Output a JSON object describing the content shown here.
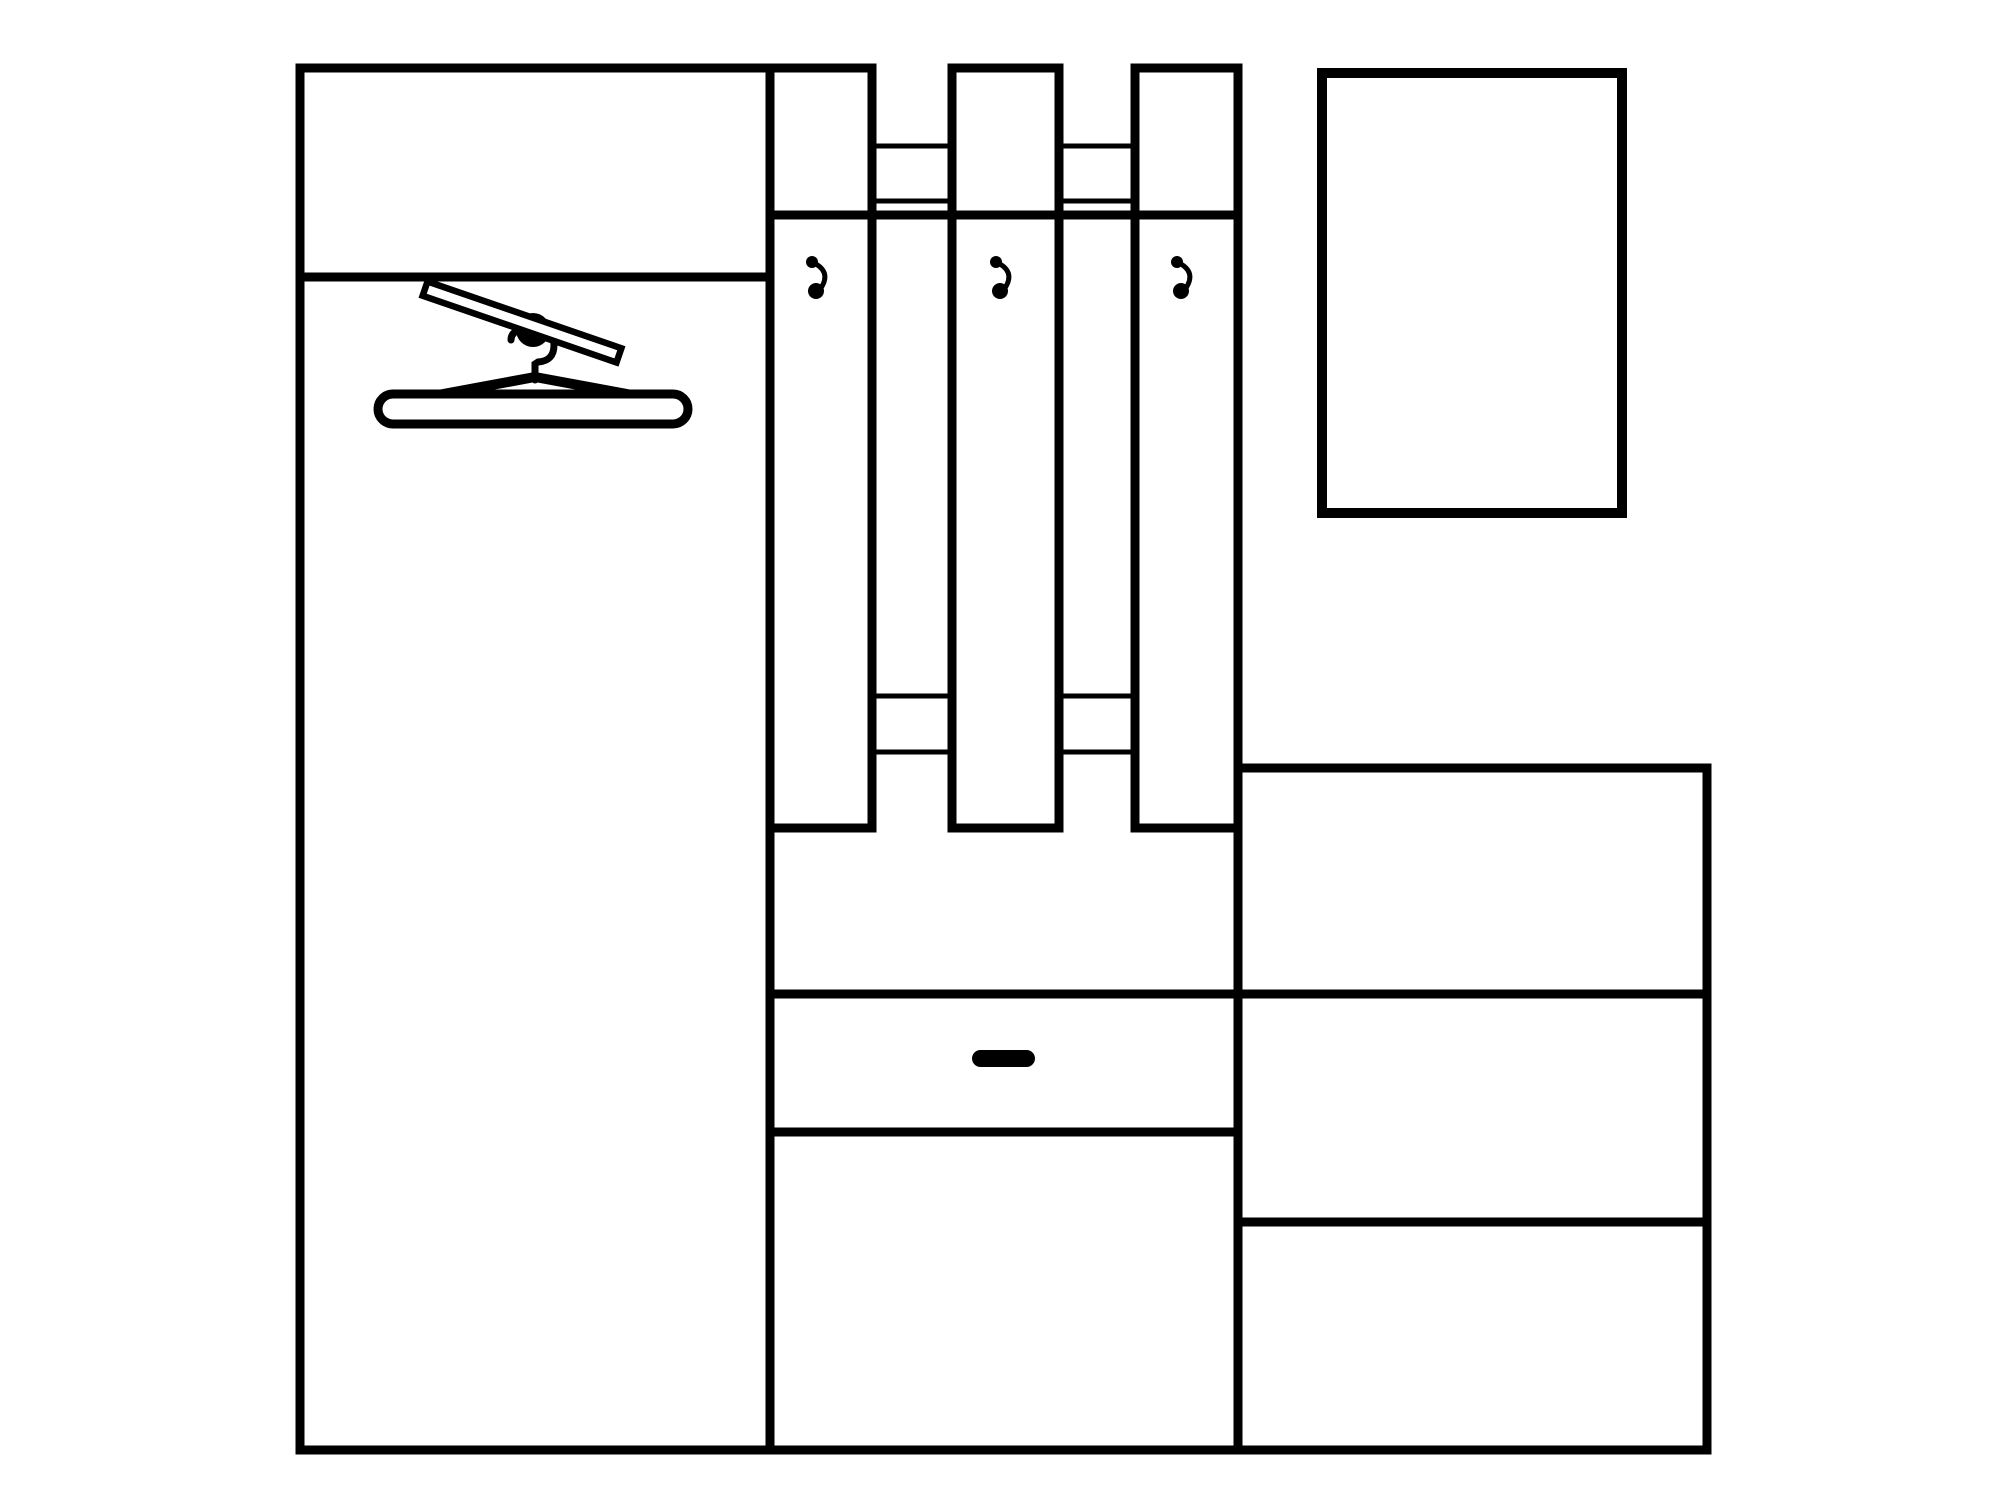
{
  "canvas": {
    "w": 2000,
    "h": 1500,
    "background": "#ffffff",
    "ink": "#000000"
  },
  "drawing": {
    "title": "hallway-furniture-line-drawing",
    "parts": [
      {
        "t": "rect",
        "name": "wardrobe-body",
        "x": 300,
        "y": 68,
        "w": 470,
        "h": 1382,
        "sw": 9
      },
      {
        "t": "line",
        "name": "wardrobe-shelf-line",
        "x1": 296,
        "y1": 277,
        "x2": 774,
        "y2": 277,
        "sw": 9
      },
      {
        "t": "rect",
        "name": "mirror",
        "x": 1322,
        "y": 73,
        "w": 300,
        "h": 440,
        "sw": 10
      },
      {
        "t": "rect",
        "name": "dresser-body",
        "x": 1238,
        "y": 768,
        "w": 469,
        "h": 682,
        "sw": 9
      },
      {
        "t": "line",
        "name": "dresser-divider-top",
        "x1": 1238,
        "y1": 994,
        "x2": 1707,
        "y2": 994,
        "sw": 9
      },
      {
        "t": "line",
        "name": "dresser-divider-bottom",
        "x1": 1238,
        "y1": 1222,
        "x2": 1707,
        "y2": 1222,
        "sw": 9
      },
      {
        "t": "line",
        "name": "cabinet-drawer-top-line",
        "x1": 770,
        "y1": 994,
        "x2": 1238,
        "y2": 994,
        "sw": 9
      },
      {
        "t": "line",
        "name": "cabinet-drawer-bottom-line",
        "x1": 770,
        "y1": 1132,
        "x2": 1238,
        "y2": 1132,
        "sw": 9
      },
      {
        "t": "line",
        "name": "cabinet-bottom-line",
        "x1": 766,
        "y1": 1450,
        "x2": 1242,
        "y2": 1450,
        "sw": 9
      },
      {
        "t": "rect",
        "name": "coat-panel-left",
        "x": 770,
        "y": 68,
        "w": 102,
        "h": 760,
        "sw": 9
      },
      {
        "t": "rect",
        "name": "coat-panel-middle",
        "x": 952,
        "y": 68,
        "w": 107,
        "h": 760,
        "sw": 9
      },
      {
        "t": "rect",
        "name": "coat-panel-right",
        "x": 1135,
        "y": 68,
        "w": 103,
        "h": 760,
        "sw": 9
      },
      {
        "t": "line",
        "name": "hat-shelf-line",
        "x1": 770,
        "y1": 215,
        "x2": 1238,
        "y2": 215,
        "sw": 9
      },
      {
        "t": "line",
        "name": "rail-upper-line1-gap1",
        "x1": 870,
        "y1": 146,
        "x2": 954,
        "y2": 146,
        "sw": 5
      },
      {
        "t": "line",
        "name": "rail-upper-line2-gap1",
        "x1": 870,
        "y1": 201,
        "x2": 954,
        "y2": 201,
        "sw": 5
      },
      {
        "t": "line",
        "name": "rail-upper-line1-gap2",
        "x1": 1057,
        "y1": 146,
        "x2": 1137,
        "y2": 146,
        "sw": 5
      },
      {
        "t": "line",
        "name": "rail-upper-line2-gap2",
        "x1": 1057,
        "y1": 201,
        "x2": 1137,
        "y2": 201,
        "sw": 5
      },
      {
        "t": "line",
        "name": "rail-lower-line1-gap1",
        "x1": 870,
        "y1": 696,
        "x2": 954,
        "y2": 696,
        "sw": 5
      },
      {
        "t": "line",
        "name": "rail-lower-line2-gap1",
        "x1": 870,
        "y1": 752,
        "x2": 954,
        "y2": 752,
        "sw": 5
      },
      {
        "t": "line",
        "name": "rail-lower-line1-gap2",
        "x1": 1057,
        "y1": 696,
        "x2": 1137,
        "y2": 696,
        "sw": 5
      },
      {
        "t": "line",
        "name": "rail-lower-line2-gap2",
        "x1": 1057,
        "y1": 752,
        "x2": 1137,
        "y2": 752,
        "sw": 5
      },
      {
        "t": "circle",
        "name": "coat-hook-1-top-dot-icon",
        "cx": 812,
        "cy": 262,
        "r": 6,
        "fill": true
      },
      {
        "t": "path",
        "name": "coat-hook-1-curve-icon",
        "d": "M 812 262 Q 832 271 821 288",
        "sw": 5
      },
      {
        "t": "circle",
        "name": "coat-hook-1-bottom-dot-icon",
        "cx": 816,
        "cy": 291,
        "r": 8,
        "fill": true
      },
      {
        "t": "circle",
        "name": "coat-hook-2-top-dot-icon",
        "cx": 996,
        "cy": 262,
        "r": 6,
        "fill": true
      },
      {
        "t": "path",
        "name": "coat-hook-2-curve-icon",
        "d": "M 996 262 Q 1016 271 1005 288",
        "sw": 5
      },
      {
        "t": "circle",
        "name": "coat-hook-2-bottom-dot-icon",
        "cx": 1000,
        "cy": 291,
        "r": 8,
        "fill": true
      },
      {
        "t": "circle",
        "name": "coat-hook-3-top-dot-icon",
        "cx": 1177,
        "cy": 262,
        "r": 6,
        "fill": true
      },
      {
        "t": "path",
        "name": "coat-hook-3-curve-icon",
        "d": "M 1177 262 Q 1197 271 1186 288",
        "sw": 5
      },
      {
        "t": "circle",
        "name": "coat-hook-3-bottom-dot-icon",
        "cx": 1181,
        "cy": 291,
        "r": 8,
        "fill": true
      },
      {
        "t": "circle",
        "name": "closet-rod-knob-icon",
        "cx": 533,
        "cy": 330,
        "r": 17,
        "fill": true
      },
      {
        "t": "path",
        "name": "hanger-hook-icon",
        "d": "M 511 340 Q 511 329 530 328 Q 554 327 554 345 Q 554 361 538 362 L 535 364 L 535 380",
        "sw": 7,
        "cap": "round"
      },
      {
        "t": "rotrect",
        "name": "closet-rod-bar-icon",
        "cx": 522,
        "cy": 322,
        "len": 205,
        "thick": 15,
        "angle": 19,
        "sw": 6.5
      },
      {
        "t": "path",
        "name": "hanger-arms-icon",
        "d": "M 400 402 L 535 377 L 670 402",
        "sw": 10,
        "cap": "round",
        "join": "round"
      },
      {
        "t": "rrect",
        "name": "hanger-bar-icon",
        "x": 378,
        "y": 394,
        "w": 310,
        "h": 30,
        "rx": 15,
        "sw": 9
      },
      {
        "t": "rrect",
        "name": "cabinet-drawer-handle",
        "x": 972,
        "y": 1050,
        "w": 63,
        "h": 17,
        "rx": 8.5,
        "sw": 0,
        "fill": true
      }
    ]
  }
}
